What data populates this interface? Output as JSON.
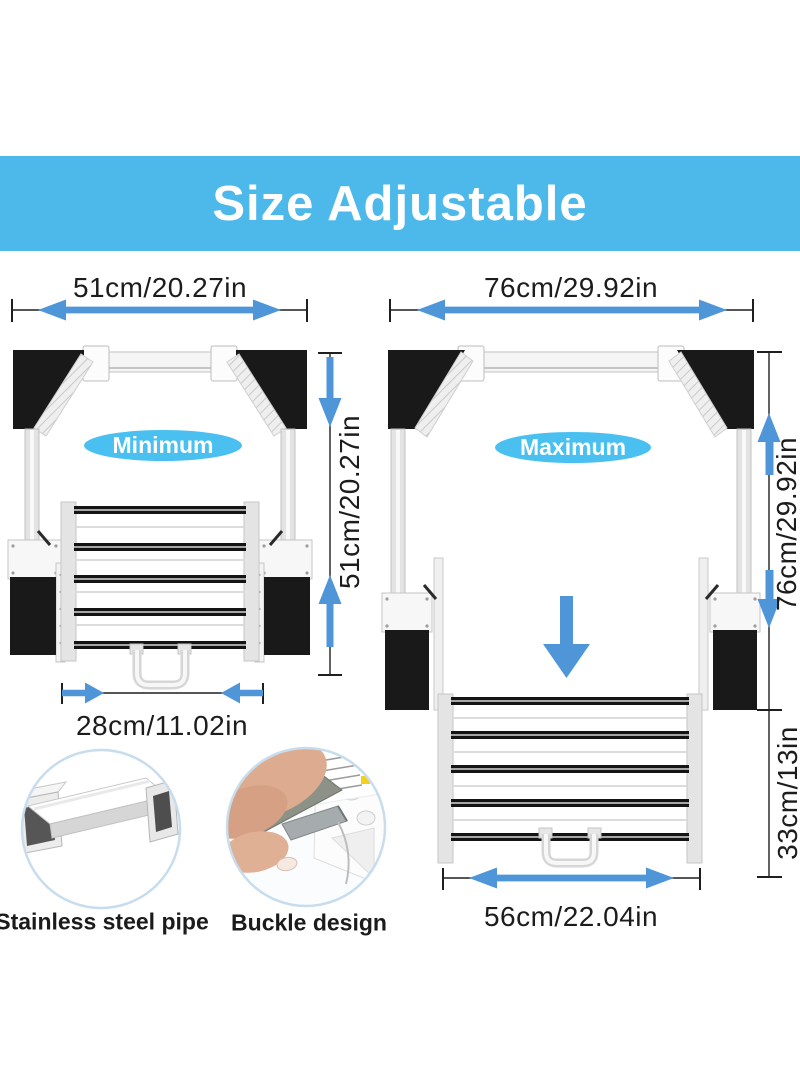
{
  "banner": {
    "title": "Size Adjustable"
  },
  "diagrams": {
    "minimum": {
      "badge": "Minimum",
      "top_width": "51cm/20.27in",
      "side_height": "51cm/20.27in",
      "bottom_width": "28cm/11.02in"
    },
    "maximum": {
      "badge": "Maximum",
      "top_width": "76cm/29.92in",
      "side_height": "76cm/29.92in",
      "lower_height": "33cm/13in",
      "bottom_width": "56cm/22.04in"
    }
  },
  "features": [
    {
      "caption": "Stainless steel pipe"
    },
    {
      "caption": "Buckle design"
    }
  ],
  "colors": {
    "banner_bg": "#4db9ea",
    "badge_bg": "#49c0f0",
    "arrow_blue": "#4f96d9",
    "line_dark": "#1f1f1f",
    "panel_black": "#191919"
  }
}
